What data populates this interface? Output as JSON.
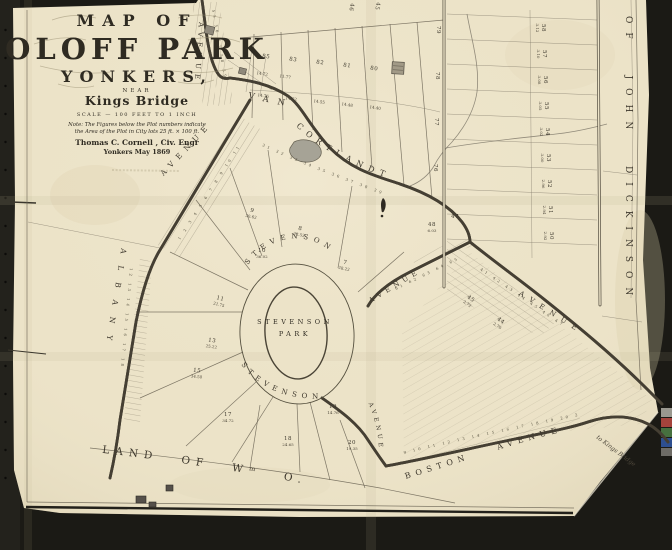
{
  "title_block": {
    "line1": "MAP OF",
    "line2": "OLOFF PARK",
    "line3": "YONKERS,",
    "line4": "NEAR",
    "line5": "Kings Bridge",
    "scale_line": "SCALE — 100 FEET TO 1 INCH",
    "note_line1": "Note: The Figures below the Plot numbers indicate",
    "note_line2": "the Area of the Plot in City lots 25 ft. × 100 ft.",
    "surveyor": "Thomas C. Cornell , Civ. Engr",
    "date_line": "Yonkers May 1869"
  },
  "streets": {
    "van_cortlandt_top_avenue": "AVENUE",
    "van": "VAN",
    "cortlandt": "CORTLANDT",
    "albany": "ALBANY",
    "albany_avenue": "AVENUE",
    "stevenson_top": "STEVENSON",
    "stevenson_ne_avenue": "AVENUE",
    "stevenson_bottom": "STEVENSON",
    "stevenson_south_avenue": "AVENUE",
    "se_avenue": "AVENUE",
    "boston_avenue": "BOSTON AVENUE"
  },
  "park": {
    "name_line1": "STEVENSON",
    "name_line2": "PARK"
  },
  "lands": {
    "giles": "LAND OF Wᵐ O. GILES",
    "dickinson": "OF JOHN DICKINSON"
  },
  "annotations": {
    "to_note": "to Kings Bridge"
  },
  "rows": [
    "31  32  33  34  35  36  37  38  39",
    "61  62  63  64  65  66",
    "9  10  11  12  13  14  15  16  17  18  19  20  21  22",
    "1  2  3  4  5  6  7  8  9  10  11",
    "12  13  14  15  16  17  18",
    "41  42  43  44  45  46  47",
    "55  56  57  58  59"
  ],
  "plots": [
    {
      "x": 266,
      "y": 58,
      "n": "85",
      "r": 8
    },
    {
      "x": 293,
      "y": 61,
      "n": "83",
      "r": 8
    },
    {
      "x": 320,
      "y": 64,
      "n": "82",
      "r": 8
    },
    {
      "x": 347,
      "y": 67,
      "n": "81",
      "r": 8
    },
    {
      "x": 374,
      "y": 70,
      "n": "80",
      "r": 8
    },
    {
      "x": 263,
      "y": 97,
      "a": "14.76",
      "r": 8
    },
    {
      "x": 291,
      "y": 100,
      "a": "14.62",
      "r": 8
    },
    {
      "x": 319,
      "y": 103,
      "a": "14.55",
      "r": 8
    },
    {
      "x": 347,
      "y": 106,
      "a": "14.48",
      "r": 8
    },
    {
      "x": 375,
      "y": 109,
      "a": "14.40",
      "r": 8
    },
    {
      "x": 262,
      "y": 75,
      "a": "14.72",
      "r": 8
    },
    {
      "x": 285,
      "y": 78,
      "a": "11.77",
      "r": 8
    },
    {
      "x": 350,
      "y": 7,
      "n": "46",
      "r": 100
    },
    {
      "x": 376,
      "y": 6,
      "n": "45",
      "r": 100
    },
    {
      "x": 252,
      "y": 212,
      "n": "9",
      "a": "30.62",
      "r": 12
    },
    {
      "x": 300,
      "y": 230,
      "n": "8",
      "a": "23.52",
      "r": 12
    },
    {
      "x": 345,
      "y": 264,
      "n": "7",
      "a": "28.22",
      "r": 12
    },
    {
      "x": 262,
      "y": 252,
      "n": "10",
      "a": "36.02",
      "r": 0
    },
    {
      "x": 220,
      "y": 300,
      "n": "11",
      "a": "21.75",
      "r": 14
    },
    {
      "x": 212,
      "y": 342,
      "n": "13",
      "a": "25.22",
      "r": 8
    },
    {
      "x": 197,
      "y": 372,
      "n": "15",
      "a": "34.50",
      "r": 6
    },
    {
      "x": 228,
      "y": 416,
      "n": "17",
      "a": "34.72",
      "r": 0
    },
    {
      "x": 288,
      "y": 440,
      "n": "18",
      "a": "24.65",
      "r": 0
    },
    {
      "x": 333,
      "y": 408,
      "n": "19",
      "a": "14.76",
      "r": 0
    },
    {
      "x": 352,
      "y": 444,
      "n": "20",
      "a": "19.35",
      "r": 0
    },
    {
      "x": 432,
      "y": 226,
      "n": "48",
      "a": "6.03",
      "r": 0
    },
    {
      "x": 455,
      "y": 218,
      "n": "47",
      "r": 0
    },
    {
      "x": 437,
      "y": 30,
      "n": "79",
      "r": 90
    },
    {
      "x": 436,
      "y": 76,
      "n": "78",
      "r": 90
    },
    {
      "x": 435,
      "y": 122,
      "n": "77",
      "r": 90
    },
    {
      "x": 434,
      "y": 168,
      "n": "76",
      "r": 90
    },
    {
      "x": 542,
      "y": 28,
      "n": "58",
      "a": "3.12",
      "r": 90
    },
    {
      "x": 543,
      "y": 54,
      "n": "57",
      "a": "3.10",
      "r": 90
    },
    {
      "x": 544,
      "y": 80,
      "n": "56",
      "a": "3.08",
      "r": 90
    },
    {
      "x": 545,
      "y": 106,
      "n": "55",
      "a": "3.05",
      "r": 90
    },
    {
      "x": 546,
      "y": 132,
      "n": "54",
      "a": "3.02",
      "r": 90
    },
    {
      "x": 547,
      "y": 158,
      "n": "53",
      "a": "3.00",
      "r": 90
    },
    {
      "x": 548,
      "y": 184,
      "n": "52",
      "a": "2.96",
      "r": 90
    },
    {
      "x": 549,
      "y": 210,
      "n": "51",
      "a": "2.94",
      "r": 90
    },
    {
      "x": 550,
      "y": 236,
      "n": "50",
      "a": "2.92",
      "r": 90
    },
    {
      "x": 470,
      "y": 300,
      "n": "45",
      "a": "2.72",
      "r": 35
    },
    {
      "x": 500,
      "y": 322,
      "n": "44",
      "a": "2.70",
      "r": 35
    }
  ],
  "colors": {
    "background": "#1b1a15",
    "paper": "#ece3c8",
    "ink": "#3a352a",
    "pond": "#a6a396"
  }
}
